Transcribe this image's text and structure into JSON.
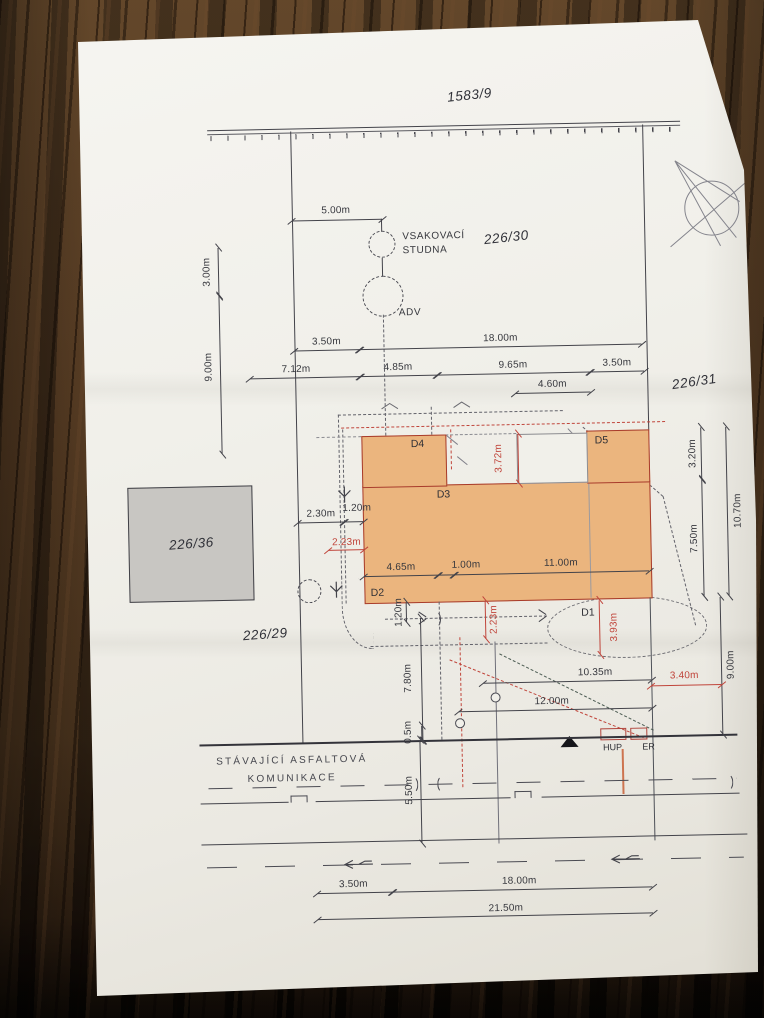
{
  "plan": {
    "parcels": {
      "north": "1583/9",
      "center": "226/30",
      "east": "226/31",
      "west_square": "226/36",
      "southwest": "226/29"
    },
    "well": {
      "name_line1": "VSAKOVACÍ",
      "name_line2": "STUDNA",
      "adv": "ADV"
    },
    "road": {
      "name_line1": "STÁVAJÍCÍ ASFALTOVÁ",
      "name_line2": "KOMUNIKACE"
    },
    "markers": {
      "d1": "D1",
      "d2": "D2",
      "d3": "D3",
      "d4": "D4",
      "d5": "D5",
      "hup": "HUP",
      "er": "ER"
    },
    "dimensions": {
      "top_offset": "5.00m",
      "left_upper": "3.00m",
      "left_lower": "9.00m",
      "rowA_left": "3.50m",
      "rowA_right": "18.00m",
      "rowB_1": "7.12m",
      "rowB_2": "4.85m",
      "rowB_3": "9.65m",
      "rowB_4": "3.50m",
      "rowC": "4.60m",
      "west_1": "2.30m",
      "west_2": "1.20m",
      "west_red": "2.23m",
      "in_1": "4.65m",
      "in_2": "1.00m",
      "in_3": "11.00m",
      "notch_red": "3.72m",
      "east_1": "3.20m",
      "east_2": "7.50m",
      "east_3": "10.70m",
      "east_4": "9.00m",
      "south_1": "1.20m",
      "south_red_1": "2.23m",
      "south_red_2": "3.93m",
      "south_2": "7.80m",
      "south_3": "10.35m",
      "south_4": "12.00m",
      "south_red_3": "3.40m",
      "road_1": "0.5m",
      "road_2": "5.50m",
      "bottom_1": "3.50m",
      "bottom_2": "18.00m",
      "bottom_3": "21.50m"
    },
    "colors": {
      "building_fill": "#ebb57e",
      "building_outline": "#a83b2b",
      "highlight_dimension": "#c0453b",
      "drawing_line": "#43434a",
      "paper": "#f1efe9",
      "table_wood": "#4c3520"
    }
  }
}
